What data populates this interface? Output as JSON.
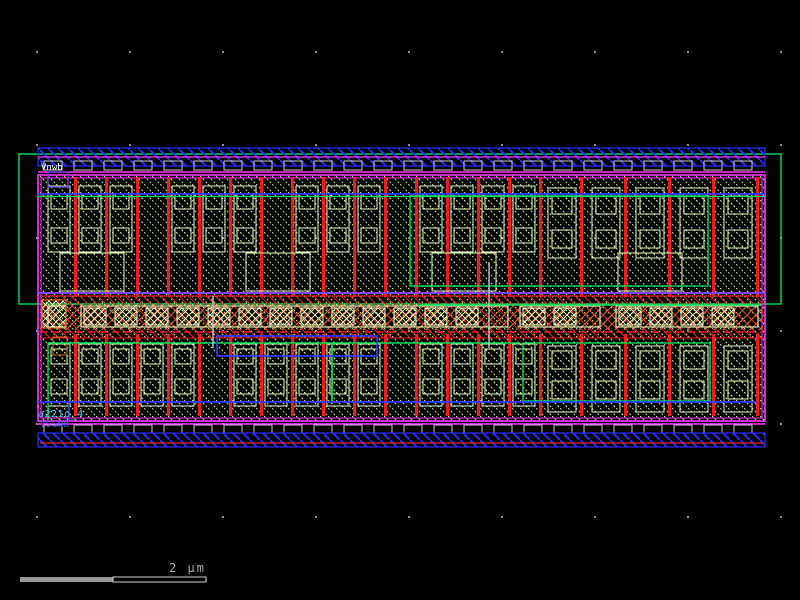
{
  "app": {
    "type": "ic-layout-viewer",
    "background": "#000000",
    "description": "Layout viewport of a standard cell with PMOS row, NMOS row, mid substrate strap, power rails and n-well outline"
  },
  "labels": {
    "top": {
      "text": "Vnwb",
      "color": "#ffffff",
      "position": "top-left-rail"
    },
    "instance": {
      "text": "a221o_4",
      "color": "#39c2ff",
      "position": "bottom-left"
    },
    "bottom": {
      "text": "VSSNB",
      "color": "#4455ff",
      "position": "bottom-left-rail"
    }
  },
  "scalebar": {
    "label": "2 μm",
    "segments": 2
  },
  "colors": {
    "bg": "#000000",
    "grid_dot": "#909090",
    "nwell": "#00e05a",
    "metal_rail": "#2a2aee",
    "via": "#c9c9c9",
    "boundary": "#ff35ff",
    "purple_line": "#8040ff",
    "active_hatch": "#b9f07d",
    "contact_outline": "#eaffc4",
    "poly": "#ee1c1c",
    "strap_orange": "#d2722a",
    "wire_blue": "#2f3cff",
    "wire_green": "#00e05a",
    "rail_red_line": "#e42222",
    "scalebar_fill": "#969696",
    "scalebar_outline": "#d0d0d0",
    "scalebar_text": "#a8a8a8"
  },
  "layers": [
    {
      "name": "n-well",
      "color": "#00e05a",
      "style": "outline"
    },
    {
      "name": "metal-rail",
      "color": "#2a2aee",
      "style": "diagonal-hatch"
    },
    {
      "name": "via-row",
      "color": "#c9c9c9",
      "style": "outline-boxes"
    },
    {
      "name": "cell-boundary",
      "color": "#ff35ff",
      "style": "double-outline"
    },
    {
      "name": "active-fill",
      "color": "#b9f07d",
      "style": "dotted-diagonal-hatch"
    },
    {
      "name": "poly-gate",
      "color": "#ee1c1c",
      "style": "solid-bars"
    },
    {
      "name": "contact",
      "color": "#eaffc4",
      "style": "outline-squares"
    },
    {
      "name": "substrate-strap",
      "color": "#d2722a",
      "style": "cross-hatch"
    },
    {
      "name": "routing-blue",
      "color": "#2f3cff",
      "style": "wire"
    },
    {
      "name": "routing-green",
      "color": "#00e05a",
      "style": "wire"
    },
    {
      "name": "grid",
      "color": "#909090",
      "style": "dots"
    }
  ]
}
